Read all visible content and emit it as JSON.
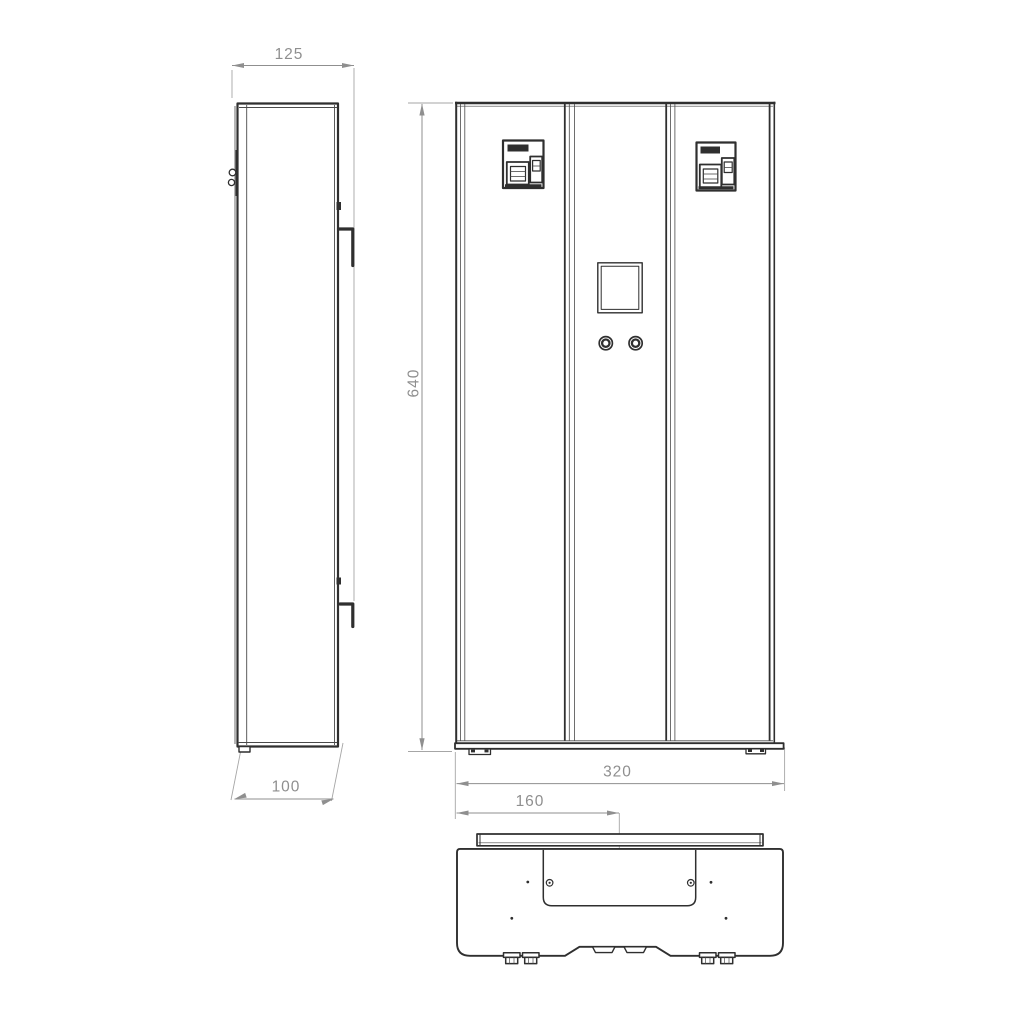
{
  "colors": {
    "outline": "#2f2f2f",
    "detail": "#4a4a4a",
    "dimension": "#8f8f8f",
    "dimension_light": "#a6a6a6",
    "background": "#ffffff"
  },
  "dimensions": {
    "depth_overall": "125",
    "depth_body": "100",
    "height": "640",
    "width": "320",
    "half_width": "160"
  }
}
